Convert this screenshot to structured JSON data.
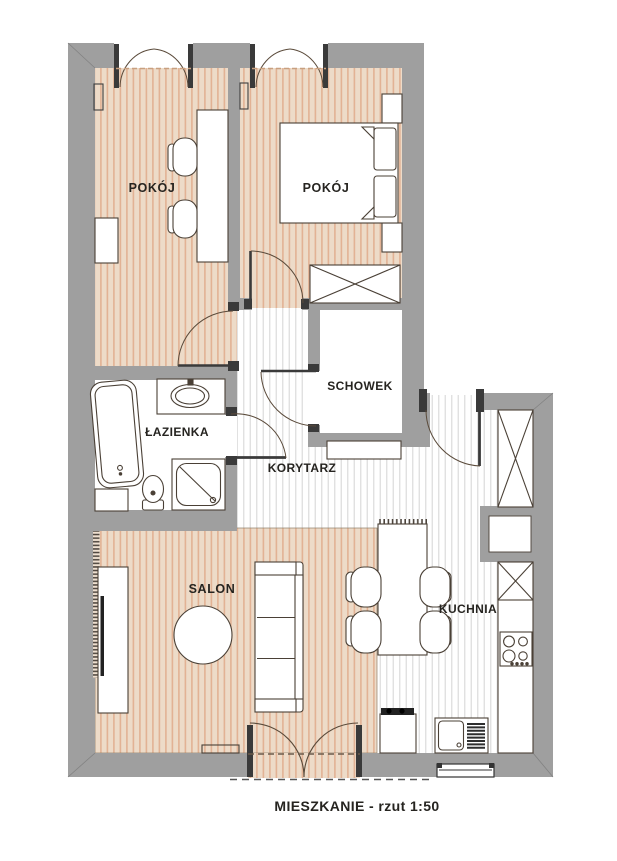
{
  "caption": "MIESZKANIE  - rzut 1:50",
  "scale": "1:50",
  "plan_type": "apartment floor plan",
  "rooms": [
    {
      "name": "pokoj-1",
      "label": "POKÓJ",
      "furniture": [
        "desk",
        "desk-chair",
        "desk-chair",
        "radiator",
        "cabinet"
      ]
    },
    {
      "name": "pokoj-2",
      "label": "POKÓJ",
      "furniture": [
        "double-bed",
        "pillow",
        "pillow",
        "nightstand",
        "nightstand",
        "wardrobe",
        "radiator"
      ]
    },
    {
      "name": "schowek",
      "label": "SCHOWEK",
      "furniture": []
    },
    {
      "name": "lazienka",
      "label": "ŁAZIENKA",
      "furniture": [
        "bathtub",
        "washing-machine",
        "washbasin",
        "toilet",
        "shower"
      ]
    },
    {
      "name": "korytarz",
      "label": "KORYTARZ",
      "furniture": [
        "cabinet"
      ]
    },
    {
      "name": "salon",
      "label": "SALON",
      "furniture": [
        "sofa",
        "coffee-table",
        "tv-cabinet",
        "radiator",
        "balcony-double-door"
      ]
    },
    {
      "name": "kuchnia",
      "label": "KUCHNIA",
      "furniture": [
        "dining-table",
        "chair",
        "chair",
        "chair",
        "chair",
        "tall-cabinet",
        "counter",
        "cooktop",
        "sink",
        "oven"
      ]
    }
  ],
  "openings": {
    "windows": 2,
    "entrance_door": 1,
    "interior_doors": 4,
    "balcony_door": 1
  },
  "colors": {
    "wall": "#9f9f9f",
    "wood_floor": "#eddbc8",
    "wood_stripe": "#e0b193",
    "light_floor": "#ffffff",
    "light_stripe": "#dedede",
    "furniture_line": "#4a4036",
    "door_arc": "#5a4a3a",
    "jamb": "#3a3a3a",
    "text": "#262420"
  }
}
